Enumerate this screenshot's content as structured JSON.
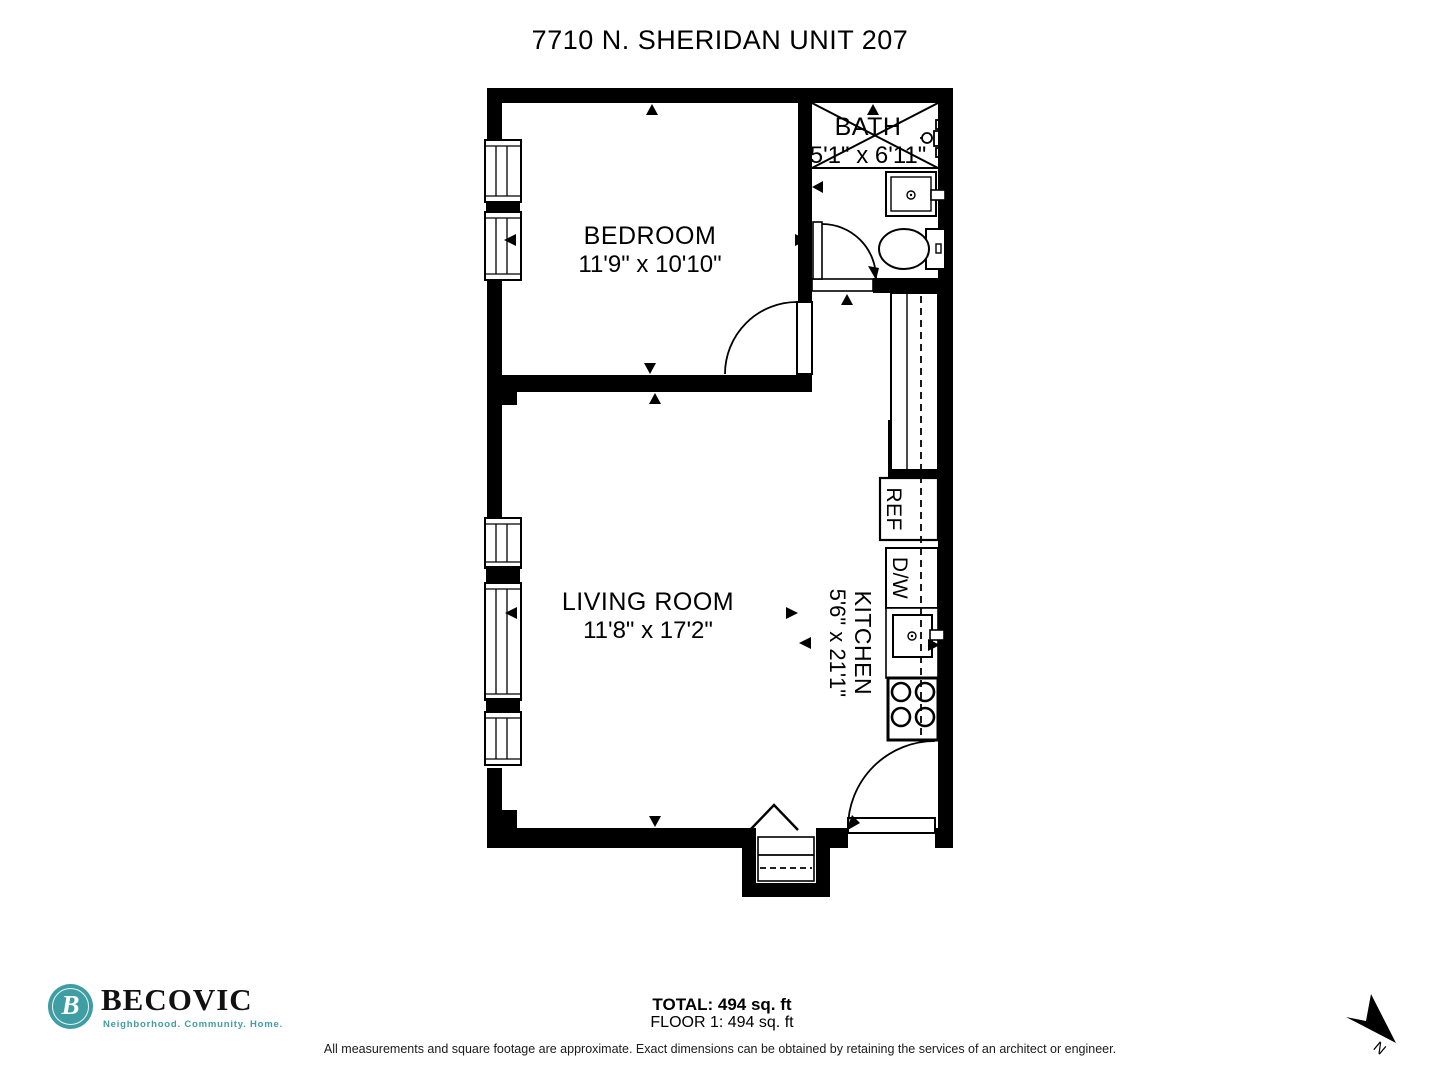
{
  "title": "7710 N. SHERIDAN UNIT 207",
  "rooms": {
    "bedroom": {
      "name": "BEDROOM",
      "dims": "11'9\" x 10'10\""
    },
    "bath": {
      "name": "BATH",
      "dims": "5'1\" x 6'11\""
    },
    "living": {
      "name": "LIVING ROOM",
      "dims": "11'8\" x 17'2\""
    },
    "kitchen": {
      "name": "KITCHEN",
      "dims": "5'6\" x 21'1\""
    }
  },
  "appliances": {
    "refrigerator": "REF",
    "dishwasher": "D/W"
  },
  "summary": {
    "total": "TOTAL: 494 sq. ft",
    "floor": "FLOOR 1: 494 sq. ft"
  },
  "disclaimer": "All measurements and square footage are approximate. Exact dimensions can be obtained by retaining the services of an architect or engineer.",
  "branding": {
    "company": "BECOVIC",
    "tagline": "Neighborhood. Community. Home.",
    "monogram": "B",
    "accent_color": "#3E9EA3"
  },
  "compass": {
    "label": "N"
  }
}
